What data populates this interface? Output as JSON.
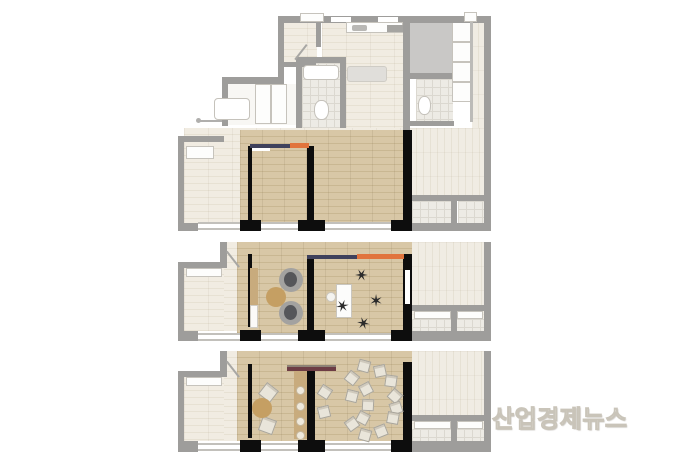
{
  "watermark": {
    "text": "산업경제뉴스"
  },
  "palette": {
    "wall_gray": "#9e9d9b",
    "wall_black": "#0d0d0d",
    "floor_faded": "#f1ece2",
    "floor_highlight_wood": "#d8c7a6",
    "accent_navy": "#3f415c",
    "accent_orange": "#e1743d",
    "accent_maroon": "#6d3c44",
    "counter_tan": "#c8ab7d",
    "table_tan": "#c59f63",
    "chair_dark": "#2b2b2b",
    "chair_light": "#e9e5da",
    "lounge_outer": "#a3a2a0",
    "lounge_inner": "#55565a"
  },
  "icons": {
    "office_chair_glyph": "✶"
  },
  "diagram": {
    "type": "floor-plan-series",
    "plans": [
      {
        "id": "plan-top",
        "variant": "unfurnished"
      },
      {
        "id": "plan-middle",
        "variant": "office-furniture"
      },
      {
        "id": "plan-bottom",
        "variant": "seminar-furniture"
      }
    ],
    "furniture": {
      "plan_middle": {
        "lounge_chairs": [
          {
            "x": 291,
            "y": 280
          },
          {
            "x": 291,
            "y": 313
          }
        ],
        "round_table": {
          "x": 276,
          "y": 297,
          "r": 10
        },
        "desk": {
          "x": 336,
          "y": 284,
          "w": 16,
          "h": 34
        },
        "desk_seat": {
          "x": 331,
          "y": 297,
          "r": 5
        },
        "office_chairs": [
          {
            "x": 342,
            "y": 307,
            "rot": 20
          },
          {
            "x": 362,
            "y": 276,
            "rot": -30
          },
          {
            "x": 375,
            "y": 301,
            "rot": 60
          },
          {
            "x": 363,
            "y": 322,
            "rot": 160
          }
        ]
      },
      "plan_bottom": {
        "square_chairs": [
          {
            "x": 269,
            "y": 393,
            "rot": 38
          },
          {
            "x": 268,
            "y": 426,
            "rot": 20
          }
        ],
        "round_table": {
          "x": 262,
          "y": 408,
          "r": 10
        },
        "counter_stools": [
          {
            "x": 300,
            "y": 390
          },
          {
            "x": 300,
            "y": 406
          },
          {
            "x": 300,
            "y": 421
          },
          {
            "x": 300,
            "y": 435
          }
        ],
        "ring_chairs": [
          {
            "x": 364,
            "y": 366,
            "rot": 15
          },
          {
            "x": 380,
            "y": 371,
            "rot": -12
          },
          {
            "x": 352,
            "y": 378,
            "rot": 38
          },
          {
            "x": 391,
            "y": 381,
            "rot": 8
          },
          {
            "x": 366,
            "y": 389,
            "rot": -28
          },
          {
            "x": 352,
            "y": 396,
            "rot": 14
          },
          {
            "x": 395,
            "y": 396,
            "rot": 42
          },
          {
            "x": 368,
            "y": 405,
            "rot": 3
          },
          {
            "x": 396,
            "y": 408,
            "rot": -18
          },
          {
            "x": 363,
            "y": 418,
            "rot": 28
          },
          {
            "x": 352,
            "y": 424,
            "rot": -36
          },
          {
            "x": 393,
            "y": 418,
            "rot": 10
          },
          {
            "x": 381,
            "y": 431,
            "rot": -22
          },
          {
            "x": 365,
            "y": 435,
            "rot": 16
          },
          {
            "x": 325,
            "y": 392,
            "rot": 33
          },
          {
            "x": 324,
            "y": 412,
            "rot": -14
          }
        ]
      }
    }
  }
}
